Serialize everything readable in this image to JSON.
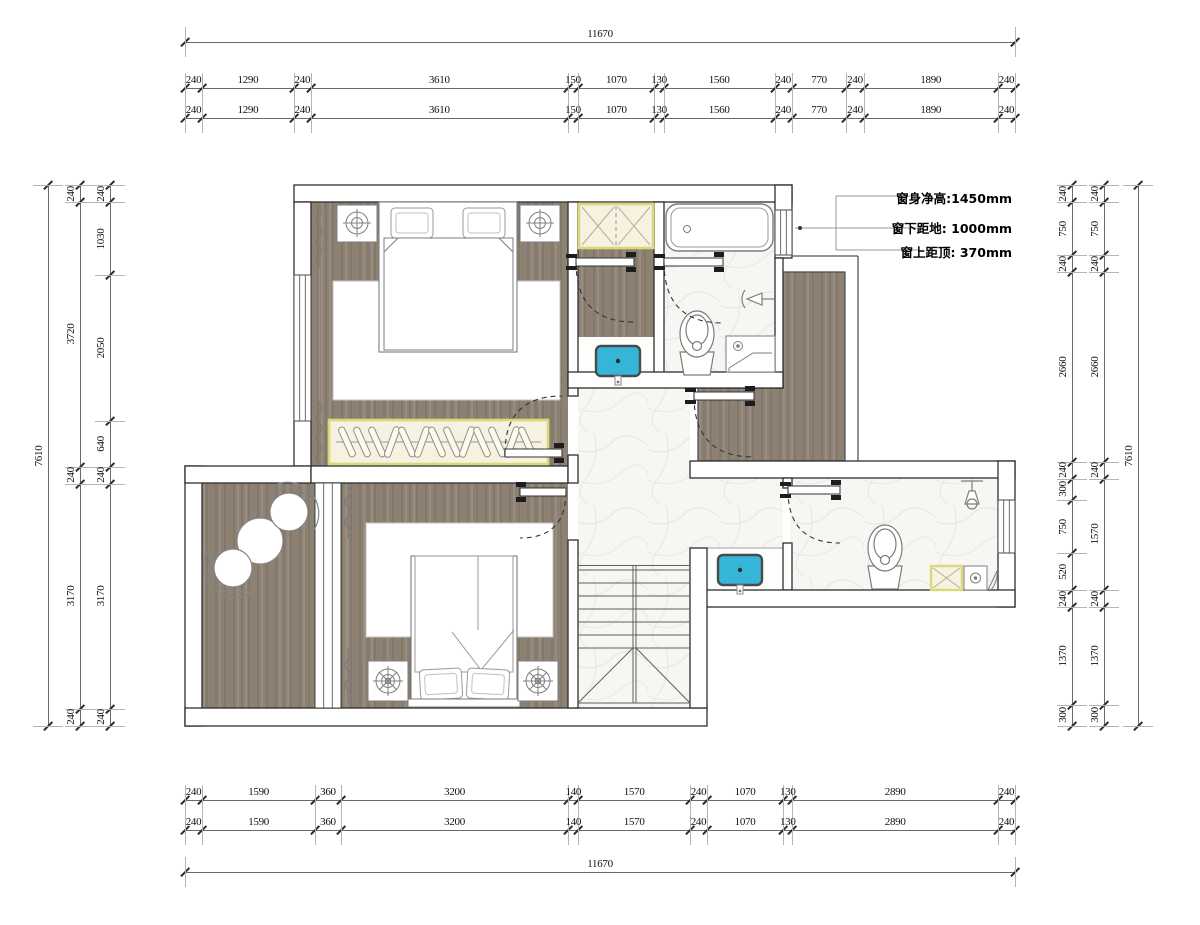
{
  "drawing": {
    "type": "floor-plan",
    "unit": "mm"
  },
  "annotation": {
    "line1": "窗身净高:1450mm",
    "line2": "窗下距地: 1000mm",
    "line3": "窗上距顶: 370mm"
  },
  "dimensions": {
    "top": {
      "total": [
        "11670"
      ],
      "row1": [
        "240",
        "1290",
        "240",
        "3610",
        "150",
        "1070",
        "130",
        "1560",
        "240",
        "770",
        "240",
        "1890",
        "240"
      ],
      "row2": [
        "240",
        "1290",
        "240",
        "3610",
        "150",
        "1070",
        "130",
        "1560",
        "240",
        "770",
        "240",
        "1890",
        "240"
      ]
    },
    "bottom": {
      "row1": [
        "240",
        "1590",
        "360",
        "3200",
        "140",
        "1570",
        "240",
        "1070",
        "130",
        "2890",
        "240"
      ],
      "row2": [
        "240",
        "1590",
        "360",
        "3200",
        "140",
        "1570",
        "240",
        "1070",
        "130",
        "2890",
        "240"
      ],
      "total": [
        "11670"
      ]
    },
    "left": {
      "total": [
        "7610"
      ],
      "mid": [
        "240",
        "3720",
        "240",
        "3170",
        "240"
      ],
      "inner": [
        "240",
        "1030",
        "2050",
        "640",
        "240",
        "3170",
        "240"
      ]
    },
    "right": {
      "inner": [
        "240",
        "750",
        "240",
        "2660",
        "240",
        "300",
        "750",
        "520",
        "240",
        "1370",
        "300"
      ],
      "mid": [
        "240",
        "750",
        "240",
        "2660",
        "240",
        "1570",
        "240",
        "1370",
        "300"
      ],
      "total": [
        "7610"
      ]
    }
  },
  "colors": {
    "wood": "#8d8173",
    "marble": "#f7f6f3",
    "wall_line": "#2e2e2e",
    "sink_blue": "#35b6d9",
    "cabinet_fill": "#f7f1df",
    "cabinet_border": "#d9d979",
    "furniture_line": "#7d7d7d",
    "dim_text": "#111111"
  },
  "fixtures": [
    "double-bed",
    "bedside-table-with-lamp",
    "wardrobe-with-hangers",
    "storage-cabinet",
    "wash-basin",
    "bathtub",
    "toilet",
    "shower-head",
    "vanity-counter",
    "stairs",
    "lounge-chair",
    "round-table",
    "floor-drain",
    "curtain",
    "door-swing",
    "window"
  ]
}
